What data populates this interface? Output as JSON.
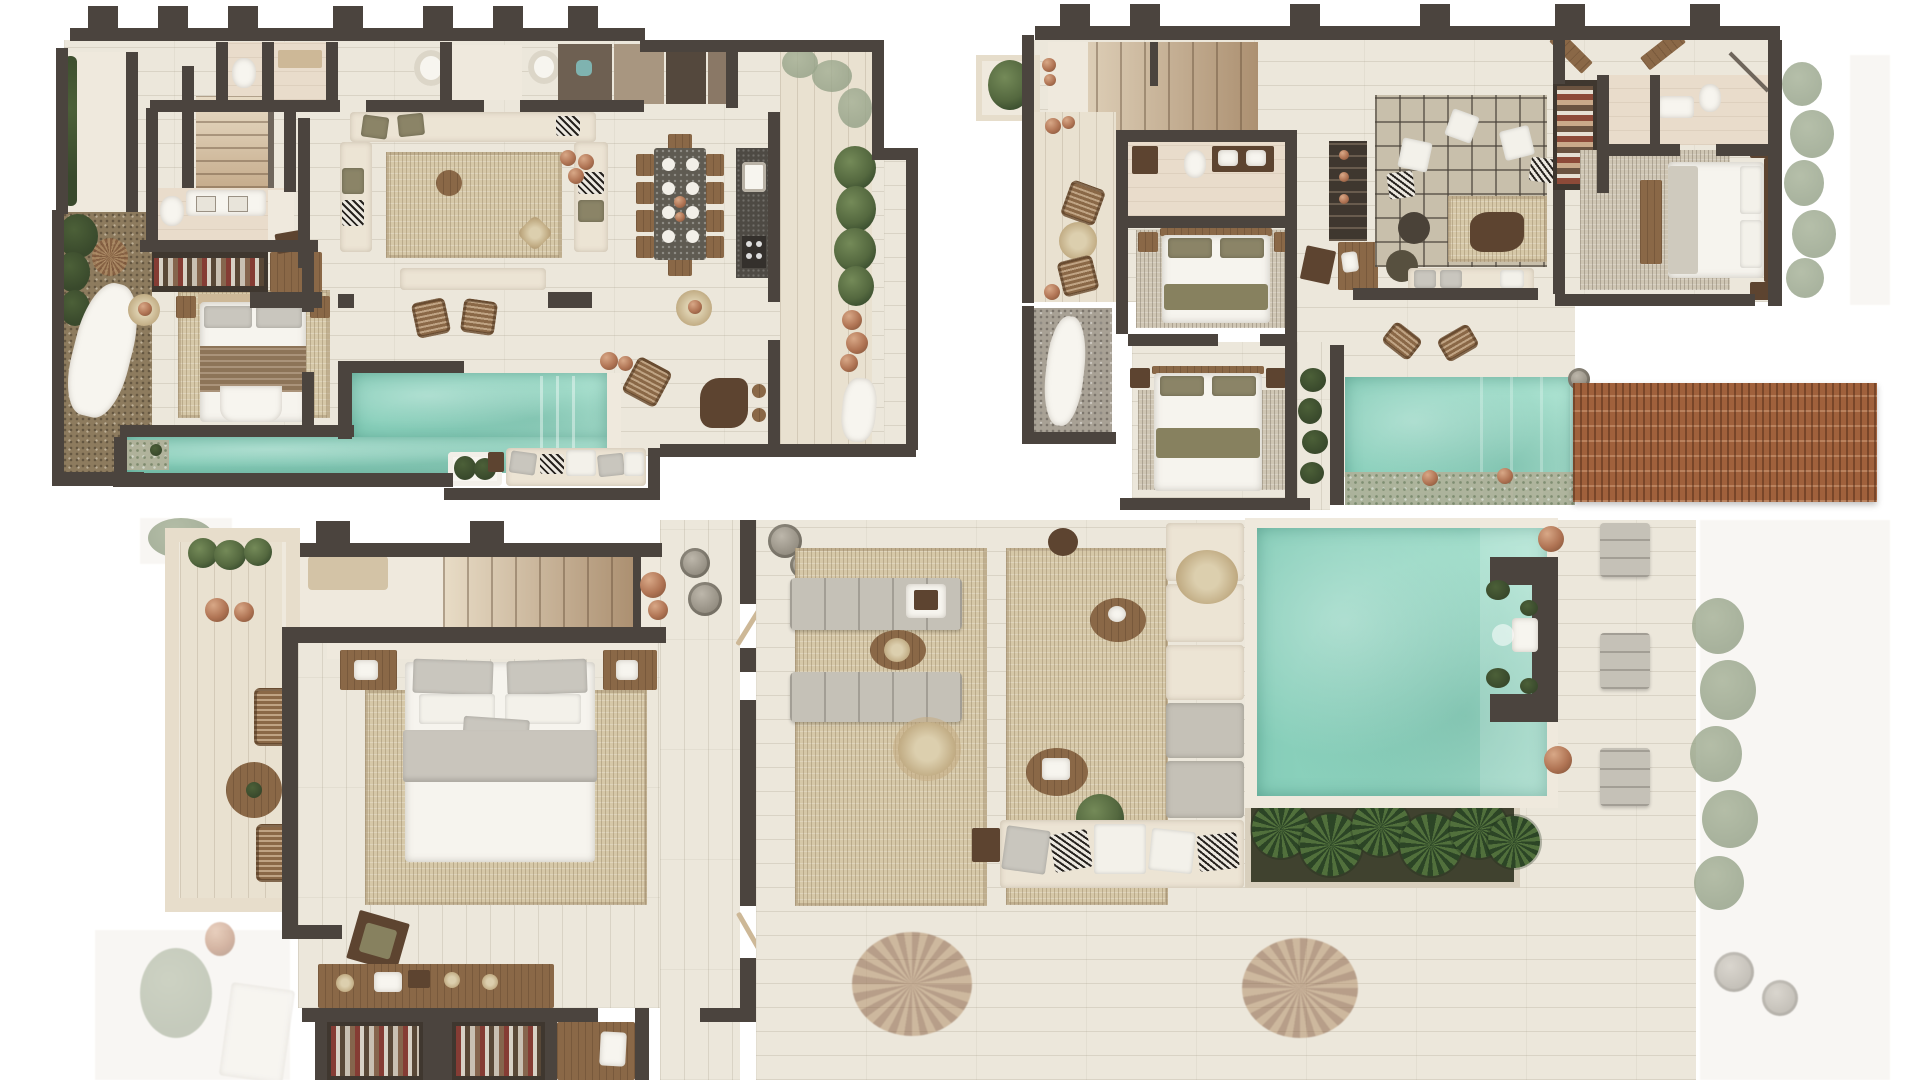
{
  "canvas": {
    "width": 1920,
    "height": 1080,
    "background": "#ffffff",
    "label": "three-villa-floor-plans-top-view"
  },
  "colors": {
    "bg": "#ffffff",
    "wall": "#4b443e",
    "wall_light": "#6f665c",
    "floor": "#ece7db",
    "deck": "#e9e1d0",
    "stone": "#efe9dd",
    "bath": "#e9dccb",
    "pool": "#92d5c1",
    "pool_light": "#aee3d2",
    "pebble": "#b4b098",
    "rug": "#d6c8a8",
    "rug_gray": "#cfc6b4",
    "grid": "#c8bfab",
    "cream": "#ece4d4",
    "gray_cushion": "#c5c1b7",
    "white": "#f7f5ef",
    "olive": "#87815f",
    "wood": "#8a6847",
    "wood_dark": "#5d4430",
    "wood_light": "#cdb897",
    "clay": "#b07454",
    "plant": "#54683f",
    "plant_dark": "#39492c",
    "plant_faded": "#93a086",
    "gravel": "#8d7b5e",
    "gravel_gray": "#a8a195",
    "pergola": "#a0613c",
    "closet": "#3f372f",
    "stair_light": "#e8dcc6",
    "stair_dark": "#ac9071"
  },
  "plans": [
    {
      "id": "plan-1",
      "label": "ground-floor-plan",
      "features": [
        "entry-court",
        "left-garden-with-hammock",
        "bedroom-with-closet",
        "bathroom",
        "powder-room",
        "stairs",
        "living-room-sectional",
        "dining-table-ten-seats",
        "kitchen-island",
        "l-shaped-lap-pool",
        "sun-deck-rattan-chairs",
        "outdoor-couch",
        "side-walkway-planter"
      ]
    },
    {
      "id": "plan-2",
      "label": "upper-floor-plan",
      "features": [
        "entry-planter",
        "stairs",
        "deck-with-stools",
        "outdoor-shower-court",
        "bathroom",
        "twin-bedroom-a",
        "twin-bedroom-b",
        "bar-cabinet",
        "living-lounge-grid-rug",
        "wardrobe-shelf",
        "main-bedroom",
        "ensuite-bathroom",
        "plunge-pool",
        "woven-pergola-deck",
        "side-planters"
      ]
    },
    {
      "id": "plan-3",
      "label": "roof-terrace-plan",
      "features": [
        "balcony-with-chairs",
        "wide-staircase",
        "master-bedroom",
        "dressing-closet",
        "desk-console",
        "corridor",
        "lounge-terrace-rugs",
        "double-sun-loungers",
        "built-in-bench",
        "outdoor-sofa",
        "palm-planter",
        "large-pool-with-fountain-wall",
        "pool-loungers",
        "faded-garden-edge"
      ]
    }
  ]
}
